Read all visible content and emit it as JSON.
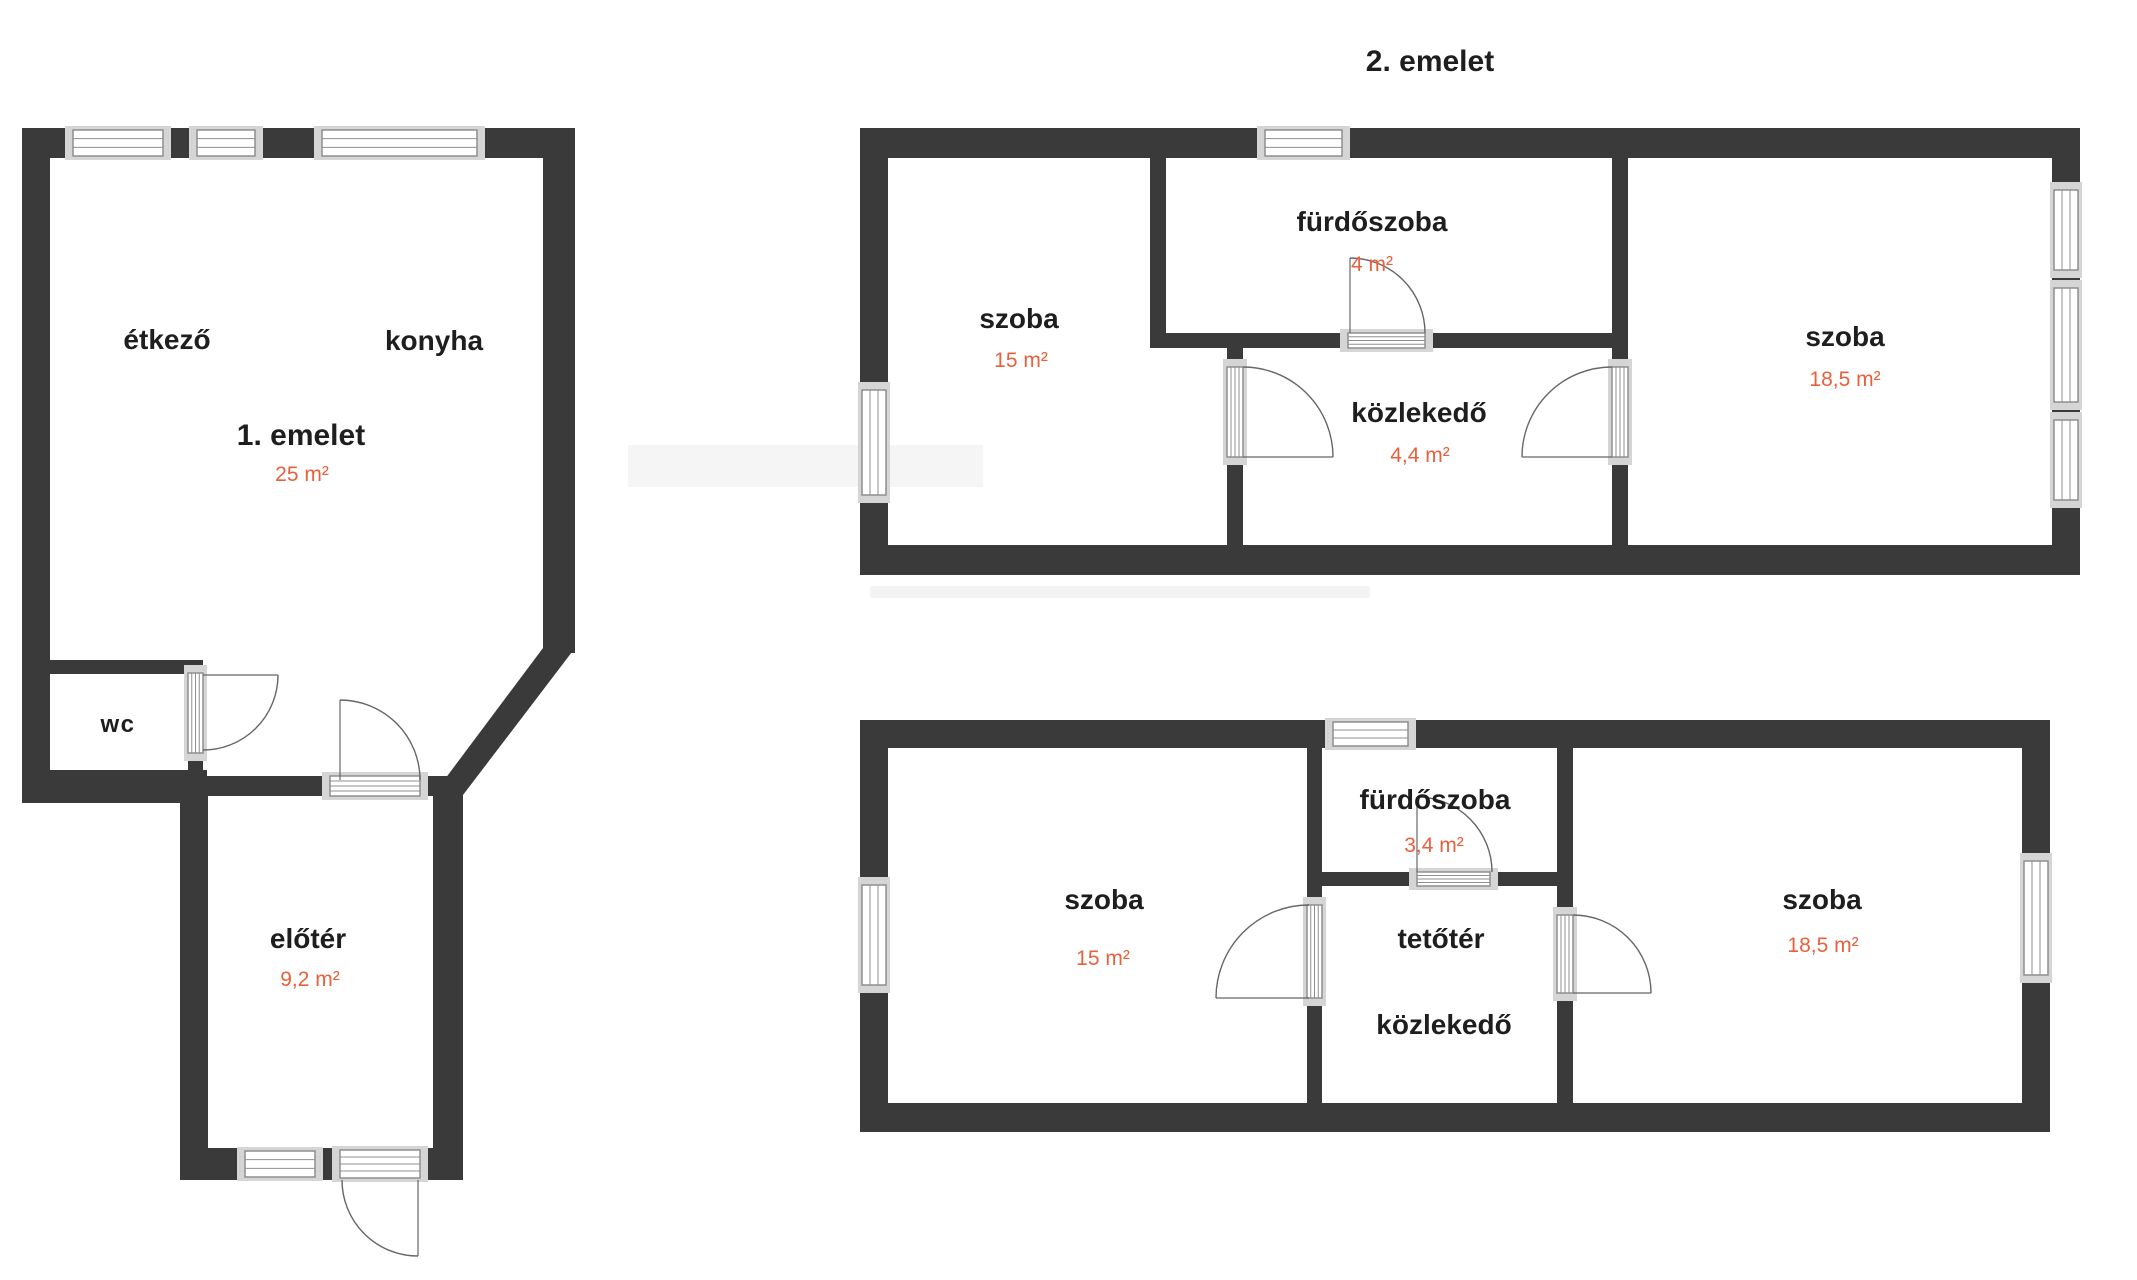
{
  "title": "2. emelet",
  "colors": {
    "wall": "#3a3a3a",
    "accent": "#e8603c",
    "text": "#1e1e1e",
    "sill": "#d5d5d5",
    "frame": "#8f8f8f"
  },
  "floor1": {
    "name_label": "1. emelet",
    "area_label": "25 m²",
    "rooms": {
      "etkezo": {
        "label": "étkező"
      },
      "konyha": {
        "label": "konyha"
      },
      "wc": {
        "label": "wc"
      },
      "eloter": {
        "label": "előtér",
        "area": "9,2 m²"
      }
    }
  },
  "floor2": {
    "rooms": {
      "szoba_left": {
        "label": "szoba",
        "area": "15 m²"
      },
      "furdoszoba": {
        "label": "fürdőszoba",
        "area": "4 m²"
      },
      "kozlekedo": {
        "label": "közlekedő",
        "area": "4,4 m²"
      },
      "szoba_right": {
        "label": "szoba",
        "area": "18,5 m²"
      }
    }
  },
  "floor3": {
    "rooms": {
      "szoba_left": {
        "label": "szoba",
        "area": "15 m²"
      },
      "furdoszoba": {
        "label": "fürdőszoba",
        "area": "3,4 m²"
      },
      "tetoter_kozlekedo": {
        "label_line1": "tetőtér",
        "label_line2": "közlekedő"
      },
      "szoba_right": {
        "label": "szoba",
        "area": "18,5 m²"
      }
    }
  }
}
